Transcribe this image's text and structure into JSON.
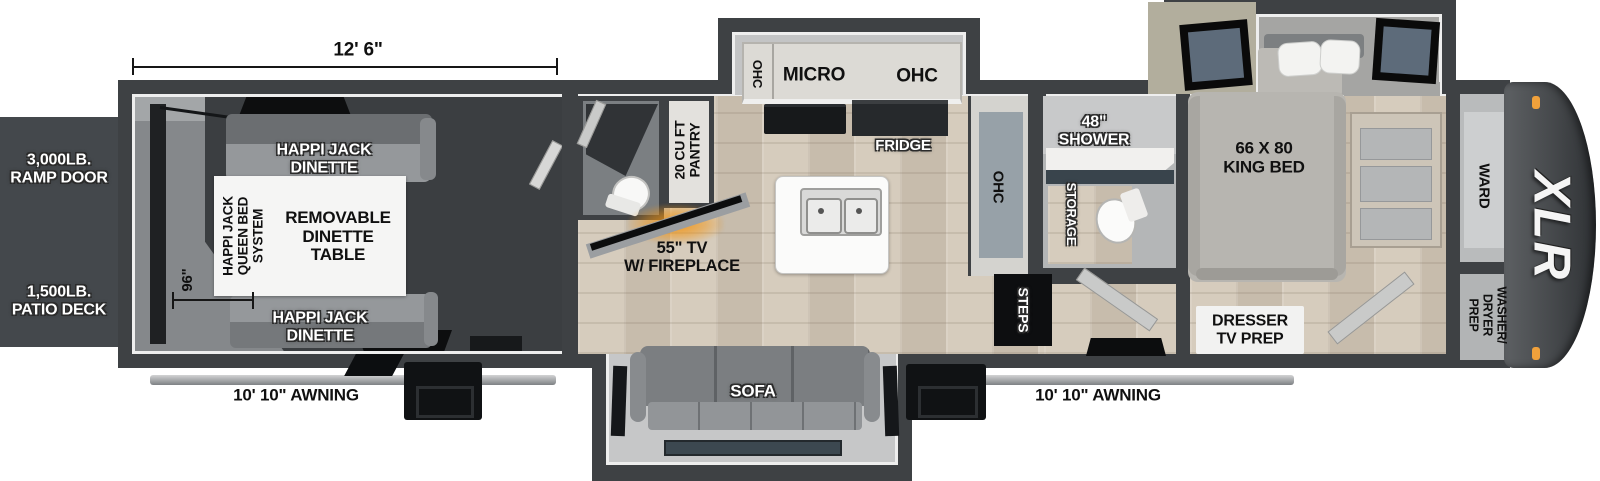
{
  "floorplan": {
    "brand": "XLR",
    "dimensions": {
      "box_length": "12' 6\"",
      "garage_width": "96\""
    },
    "exterior": {
      "ramp_door": "3,000LB.\nRAMP DOOR",
      "patio_deck": "1,500LB.\nPATIO DECK",
      "awning_left": "10' 10\" AWNING",
      "awning_right": "10' 10\" AWNING"
    },
    "garage": {
      "dinette_top": "HAPPI JACK\nDINETTE",
      "dinette_bottom": "HAPPI JACK\nDINETTE",
      "queen_bed_system": "HAPPI JACK\nQUEEN BED\nSYSTEM",
      "dinette_table": "REMOVABLE\nDINETTE\nTABLE"
    },
    "kitchen": {
      "ohc_left": "OHC",
      "micro": "MICRO",
      "ohc_right": "OHC",
      "fridge": "FRIDGE",
      "pantry": "20 CU FT\nPANTRY",
      "ohc_tall": "OHC",
      "tv_fireplace": "55\" TV\nW/ FIREPLACE"
    },
    "living": {
      "sofa": "SOFA",
      "steps": "STEPS"
    },
    "bathroom": {
      "shower": "48\"\nSHOWER",
      "storage": "STORAGE"
    },
    "bedroom": {
      "king_bed": "66 X 80\nKING BED",
      "dresser_tv": "DRESSER\nTV PREP",
      "wardrobe": "WARD",
      "washer_dryer": "WASHER/\nDRYER\nPREP"
    },
    "colors": {
      "wall": "#3e4144",
      "flame_accent": "#f09a2a",
      "marker_light": "#f0a13b",
      "wood_floor": "#cfc5b6",
      "garage_floor": "#3b3e41"
    }
  }
}
